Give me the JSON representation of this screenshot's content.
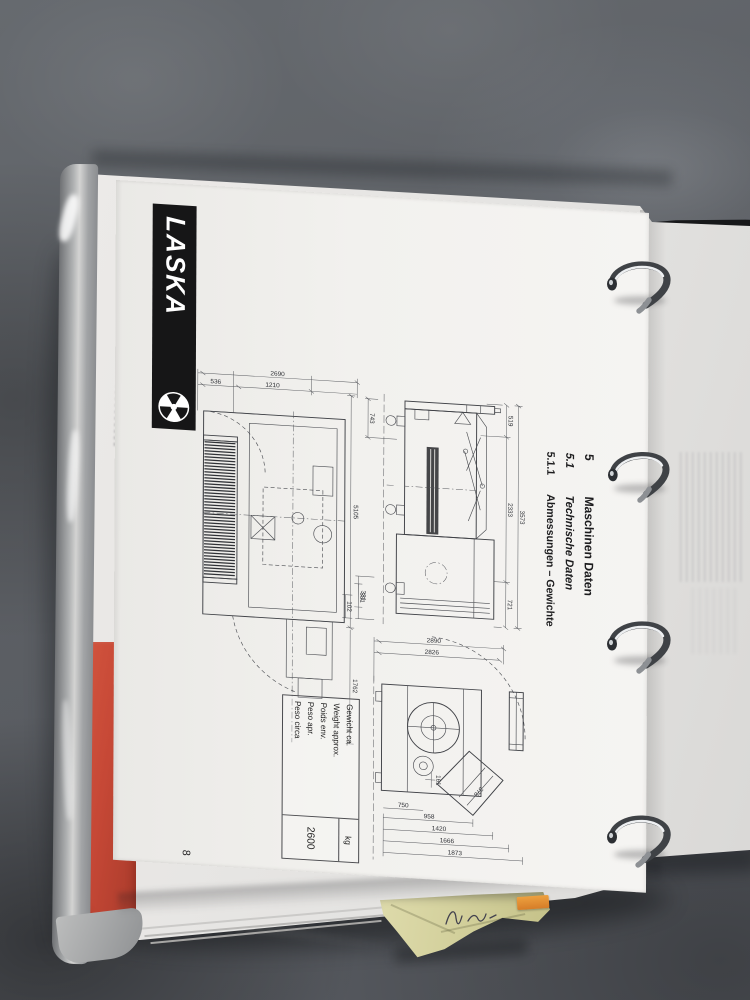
{
  "document": {
    "brand": "LASKA",
    "headings": [
      {
        "number": "5",
        "title": "Maschinen Daten"
      },
      {
        "number": "5.1",
        "title": "Technische Daten"
      },
      {
        "number": "5.1.1",
        "title": "Abmessungen – Gewichte"
      }
    ],
    "page_number": "8",
    "weight_table": {
      "labels": [
        "Gewicht ca.",
        "Weight approx.",
        "Poids env.",
        "Peso apr.",
        "Peso circa"
      ],
      "unit": "kg",
      "value": "2600"
    },
    "drawings": {
      "plan_view": {
        "width_total": "2690",
        "width_seg1": "536",
        "width_seg2": "1210",
        "length": "5105",
        "detail": "331",
        "side": "1762"
      },
      "side_view": {
        "seg1": "519",
        "seg2": "2333",
        "seg3": "721",
        "total": "3573",
        "front": "743",
        "detail1": "331",
        "detail2": "102"
      },
      "front_view": {
        "height_outer": "2890",
        "height_inner": "2826",
        "chain1": "958",
        "chain2": "1420",
        "chain3": "1666",
        "chain4": "1873",
        "base": "750",
        "diag": "378",
        "detail": "161"
      }
    }
  },
  "colors": {
    "desk": "#5d6065",
    "binder_cover": "#17181a",
    "red_cover": "#c64836",
    "sticky_note": "#d3d09c",
    "orange_tab": "#e08a30",
    "ring_metal": "#3f4246",
    "page": "#f3f2ef"
  }
}
